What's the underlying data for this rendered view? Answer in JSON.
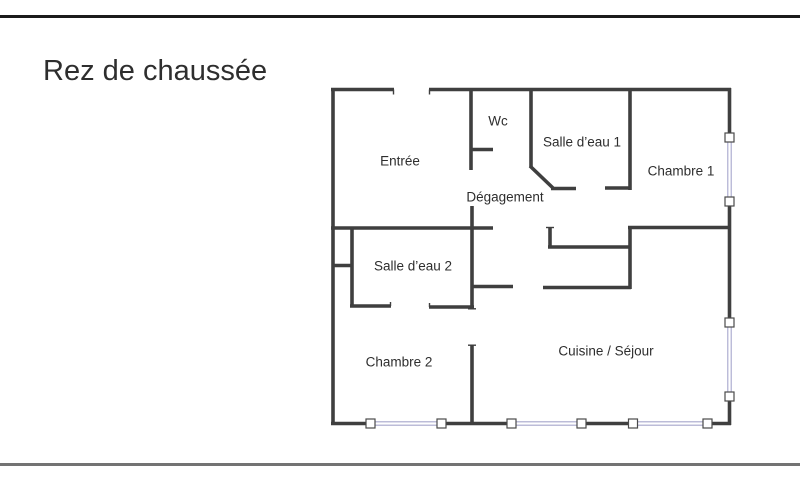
{
  "page": {
    "title": "Rez de chaussée",
    "top_border_color": "#1b1b1b",
    "bottom_border_color": "#737373",
    "background_color": "#ffffff"
  },
  "floorplan": {
    "wall_color": "#3f3f3f",
    "window_color": "#a6a6cc",
    "window_cap_fill": "#ffffff",
    "window_cap_border": "#4a4a4a",
    "text_color": "#2e2e2e",
    "rooms": [
      {
        "id": "entree",
        "label": "Entrée",
        "x": 400,
        "y": 161
      },
      {
        "id": "wc",
        "label": "Wc",
        "x": 498,
        "y": 121
      },
      {
        "id": "salle-deau-1",
        "label": "Salle d’eau 1",
        "x": 582,
        "y": 142
      },
      {
        "id": "chambre-1",
        "label": "Chambre 1",
        "x": 681,
        "y": 171
      },
      {
        "id": "degagement",
        "label": "Dégagement",
        "x": 505,
        "y": 197
      },
      {
        "id": "salle-deau-2",
        "label": "Salle d’eau 2",
        "x": 413,
        "y": 266
      },
      {
        "id": "chambre-2",
        "label": "Chambre 2",
        "x": 399,
        "y": 362
      },
      {
        "id": "cuisine-sejour",
        "label": "Cuisine / Séjour",
        "x": 606,
        "y": 351
      }
    ],
    "walls": [
      [
        331,
        89.5,
        394,
        89.5
      ],
      [
        429,
        89.5,
        731,
        89.5
      ],
      [
        333,
        88,
        333,
        425
      ],
      [
        729.5,
        88,
        729.5,
        134
      ],
      [
        729.5,
        205,
        729.5,
        319
      ],
      [
        729.5,
        400,
        729.5,
        425
      ],
      [
        331,
        423.5,
        368,
        423.5
      ],
      [
        445,
        423.5,
        508,
        423.5
      ],
      [
        585,
        423.5,
        630,
        423.5
      ],
      [
        705,
        423.5,
        731,
        423.5
      ],
      [
        471,
        89,
        471,
        170
      ],
      [
        471,
        149.5,
        493,
        149.5
      ],
      [
        531,
        89,
        531,
        167
      ],
      [
        530,
        166,
        553,
        188
      ],
      [
        551,
        188.5,
        576,
        188.5
      ],
      [
        605,
        188,
        631,
        188
      ],
      [
        630,
        89,
        630,
        190
      ],
      [
        331,
        228,
        493,
        228
      ],
      [
        352,
        228,
        352,
        307
      ],
      [
        333,
        265.5,
        352,
        265.5
      ],
      [
        350,
        306,
        391,
        306
      ],
      [
        429,
        307,
        474,
        307
      ],
      [
        472,
        206,
        472,
        309
      ],
      [
        472,
        345,
        472,
        425
      ],
      [
        472,
        286.5,
        513,
        286.5
      ],
      [
        543,
        287.5,
        631,
        287.5
      ],
      [
        548,
        247,
        631,
        247
      ],
      [
        550,
        227,
        550,
        248
      ],
      [
        628,
        227.5,
        731,
        227.5
      ],
      [
        630,
        226,
        630,
        289
      ]
    ],
    "ticks": [
      [
        393.5,
        89.5,
        393.5,
        94.5
      ],
      [
        429.5,
        89.5,
        429.5,
        94.5
      ],
      [
        390.5,
        302,
        390.5,
        306
      ],
      [
        429.5,
        303,
        429.5,
        307
      ],
      [
        468,
        345.2,
        476,
        345.2
      ],
      [
        468,
        308.8,
        476,
        308.8
      ],
      [
        546,
        227.5,
        554,
        227.5
      ]
    ],
    "windows": [
      {
        "axis": "h",
        "y": 423.5,
        "from": 375,
        "to": 437
      },
      {
        "axis": "h",
        "y": 423.5,
        "from": 516,
        "to": 577
      },
      {
        "axis": "h",
        "y": 423.5,
        "from": 637,
        "to": 703
      },
      {
        "axis": "v",
        "x": 729.5,
        "from": 142,
        "to": 197
      },
      {
        "axis": "v",
        "x": 729.5,
        "from": 327,
        "to": 392
      }
    ],
    "window_caps": [
      {
        "x": 370.5,
        "y": 423.5
      },
      {
        "x": 441.5,
        "y": 423.5
      },
      {
        "x": 511.5,
        "y": 423.5
      },
      {
        "x": 581.5,
        "y": 423.5
      },
      {
        "x": 633,
        "y": 423.5
      },
      {
        "x": 707.5,
        "y": 423.5
      },
      {
        "x": 729.5,
        "y": 137.5
      },
      {
        "x": 729.5,
        "y": 201.5
      },
      {
        "x": 729.5,
        "y": 322.5
      },
      {
        "x": 729.5,
        "y": 396.5
      }
    ]
  }
}
